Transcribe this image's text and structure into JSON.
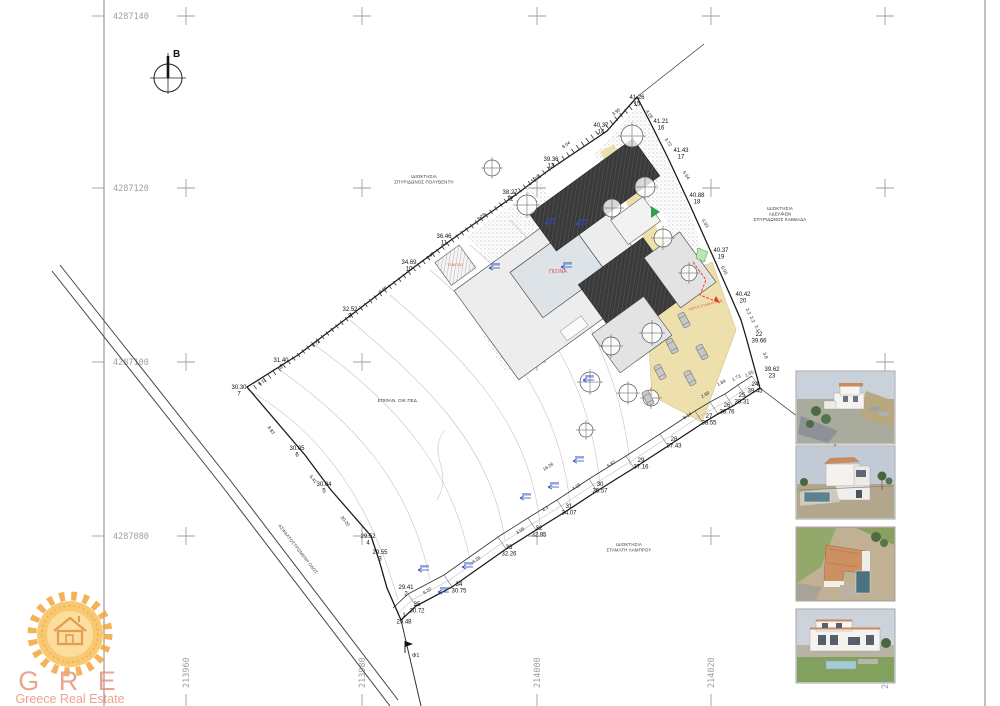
{
  "colors": {
    "road_beige": "#eee0ac",
    "roof_dark": "#3a3a3a",
    "building_gray": "#e3e3e3",
    "pool_label_red": "#e05555",
    "marker_blue": "#2b50c8",
    "green_marker": "#2e9e4f",
    "grid_gray": "#9aa0a6",
    "logo_orange": "#f3a63e",
    "logo_text": "#e8947c"
  },
  "north": {
    "label": "B"
  },
  "grid": {
    "cols": [
      186,
      362,
      537,
      711,
      885
    ],
    "rows": [
      16,
      188,
      362,
      536
    ],
    "row_labels": [
      {
        "text": "4287140",
        "y": 16
      },
      {
        "text": "4287120",
        "y": 188
      },
      {
        "text": "4287100",
        "y": 362
      },
      {
        "text": "4287080",
        "y": 536
      }
    ],
    "col_labels": [
      {
        "text": "213960",
        "x": 186
      },
      {
        "text": "213980",
        "x": 362
      },
      {
        "text": "214000",
        "x": 537
      },
      {
        "text": "214020",
        "x": 711
      }
    ],
    "partial_col_label": {
      "text": "2",
      "x": 885,
      "y": 689
    }
  },
  "plan": {
    "owners": [
      {
        "x": 424,
        "y": 178,
        "lines": [
          "ΙΔΙΟΚΤΗΣΙΑ",
          "ΣΠΥΡΙΔΩΝΟΣ ΠΟΛΥΒΕΝΤΗ"
        ]
      },
      {
        "x": 780,
        "y": 210,
        "lines": [
          "ΙΔΙΟΚΤΗΣΙΑ",
          "ΑΔΕΛΦΩΝ",
          "ΣΠΥΡΙΔΩΝΟΣ ΚΑΒΒΑΔΑ"
        ]
      },
      {
        "x": 629,
        "y": 546,
        "lines": [
          "ΙΔΙΟΚΤΗΣΙΑ",
          "ΣΤΑΜΑΤΗ ΛΑΜΠΡΟΥ"
        ]
      }
    ],
    "road_label": "ΑΣΦΑΛΤΟΣΤΡΩΜΕΝΗ ΟΔΟΣ",
    "area_label": "ΕΠΙΦΑΝ. ΟΙΚ.ΠΕΔ.",
    "pool_label": "ΠΙΣΙΝΑ",
    "jacuzzi_label": "ΤΖΑΚΟΥΖΙ",
    "parking_label": "ΧΩΡΟΣ ΣΤΑΘΜΕΥΣΗΣ",
    "flag_label": "Φ1",
    "points": [
      {
        "l1": "1",
        "l2": "29.48",
        "x": 404,
        "y": 617
      },
      {
        "l1": "29.41",
        "l2": "2",
        "x": 406,
        "y": 589
      },
      {
        "l1": "29.55",
        "l2": "3",
        "x": 380,
        "y": 554
      },
      {
        "l1": "29.52",
        "l2": "4",
        "x": 368,
        "y": 538
      },
      {
        "l1": "30.04",
        "l2": "5",
        "x": 324,
        "y": 486
      },
      {
        "l1": "30.05",
        "l2": "6",
        "x": 297,
        "y": 450
      },
      {
        "l1": "30.30",
        "l2": "7",
        "x": 239,
        "y": 389
      },
      {
        "l1": "31.40",
        "l2": "8",
        "x": 281,
        "y": 362
      },
      {
        "l1": "32.52",
        "l2": "9",
        "x": 350,
        "y": 311
      },
      {
        "l1": "34.69",
        "l2": "10",
        "x": 409,
        "y": 264
      },
      {
        "l1": "36.46",
        "l2": "11",
        "x": 444,
        "y": 238
      },
      {
        "l1": "38.27",
        "l2": "12",
        "x": 510,
        "y": 194
      },
      {
        "l1": "39.36",
        "l2": "13",
        "x": 551,
        "y": 161
      },
      {
        "l1": "40.37",
        "l2": "14",
        "x": 601,
        "y": 127
      },
      {
        "l1": "41.26",
        "l2": "15",
        "x": 637,
        "y": 99
      },
      {
        "l1": "41.21",
        "l2": "16",
        "x": 661,
        "y": 123
      },
      {
        "l1": "41.43",
        "l2": "17",
        "x": 681,
        "y": 152
      },
      {
        "l1": "40.88",
        "l2": "18",
        "x": 697,
        "y": 197
      },
      {
        "l1": "40.37",
        "l2": "19",
        "x": 721,
        "y": 252
      },
      {
        "l1": "40.42",
        "l2": "20",
        "x": 743,
        "y": 296
      },
      {
        "l1": "22",
        "l2": "39.66",
        "x": 759,
        "y": 336
      },
      {
        "l1": "39.62",
        "l2": "23",
        "x": 772,
        "y": 371
      },
      {
        "l1": "24",
        "l2": "39.45",
        "x": 755,
        "y": 386
      },
      {
        "l1": "25",
        "l2": "39.31",
        "x": 742,
        "y": 397
      },
      {
        "l1": "26",
        "l2": "38.76",
        "x": 727,
        "y": 407
      },
      {
        "l1": "27",
        "l2": "38.55",
        "x": 709,
        "y": 418
      },
      {
        "l1": "28",
        "l2": "37.43",
        "x": 674,
        "y": 441
      },
      {
        "l1": "29",
        "l2": "37.16",
        "x": 641,
        "y": 462
      },
      {
        "l1": "30",
        "l2": "35.57",
        "x": 600,
        "y": 486
      },
      {
        "l1": "31",
        "l2": "34.07",
        "x": 569,
        "y": 508
      },
      {
        "l1": "32",
        "l2": "32.95",
        "x": 539,
        "y": 530
      },
      {
        "l1": "33",
        "l2": "32.26",
        "x": 509,
        "y": 549
      },
      {
        "l1": "34",
        "l2": "30.75",
        "x": 459,
        "y": 586
      },
      {
        "l1": "35",
        "l2": "30.72",
        "x": 417,
        "y": 606
      }
    ],
    "edge_labels": [
      {
        "t": "3.95",
        "x": 617,
        "y": 113,
        "r": -36
      },
      {
        "t": "8.04",
        "x": 567,
        "y": 146,
        "r": -36
      },
      {
        "t": "5.19",
        "x": 536,
        "y": 180,
        "r": -36
      },
      {
        "t": "9.29",
        "x": 482,
        "y": 218,
        "r": -36
      },
      {
        "t": "4.47",
        "x": 431,
        "y": 257,
        "r": -36
      },
      {
        "t": "9.55",
        "x": 384,
        "y": 291,
        "r": -36
      },
      {
        "t": "9.74",
        "x": 317,
        "y": 345,
        "r": -36
      },
      {
        "t": "6.11",
        "x": 263,
        "y": 383,
        "r": -36
      },
      {
        "t": "8.83",
        "x": 270,
        "y": 431,
        "r": 52
      },
      {
        "t": "5.41",
        "x": 312,
        "y": 480,
        "r": 52
      },
      {
        "t": "20-20",
        "x": 344,
        "y": 522,
        "r": 52
      },
      {
        "t": "4.28",
        "x": 648,
        "y": 115,
        "r": 56
      },
      {
        "t": "3.72",
        "x": 667,
        "y": 143,
        "r": 56
      },
      {
        "t": "5.64",
        "x": 685,
        "y": 176,
        "r": 56
      },
      {
        "t": "6.03",
        "x": 704,
        "y": 224,
        "r": 60
      },
      {
        "t": "6.05",
        "x": 723,
        "y": 271,
        "r": 62
      },
      {
        "t": "2.2",
        "x": 747,
        "y": 312,
        "r": 65
      },
      {
        "t": "2.2",
        "x": 751,
        "y": 320,
        "r": 65
      },
      {
        "t": "2.1",
        "x": 756,
        "y": 329,
        "r": 65
      },
      {
        "t": "3.8",
        "x": 764,
        "y": 356,
        "r": 70
      },
      {
        "t": "1.84",
        "x": 722,
        "y": 384,
        "r": -28
      },
      {
        "t": "1.73",
        "x": 737,
        "y": 379,
        "r": -28
      },
      {
        "t": "1.65",
        "x": 750,
        "y": 375,
        "r": -28
      },
      {
        "t": "2.58",
        "x": 706,
        "y": 396,
        "r": -32
      },
      {
        "t": "6.14",
        "x": 688,
        "y": 417,
        "r": -32
      },
      {
        "t": "6.82",
        "x": 612,
        "y": 465,
        "r": -33
      },
      {
        "t": "4.18",
        "x": 577,
        "y": 488,
        "r": -33
      },
      {
        "t": "4.3",
        "x": 546,
        "y": 510,
        "r": -33
      },
      {
        "t": "3.08",
        "x": 521,
        "y": 532,
        "r": -33
      },
      {
        "t": "4.28",
        "x": 477,
        "y": 561,
        "r": -33
      },
      {
        "t": "6.20",
        "x": 428,
        "y": 592,
        "r": -33
      },
      {
        "t": "16.26",
        "x": 549,
        "y": 468,
        "r": -33
      }
    ],
    "trees": [
      [
        632,
        136,
        11
      ],
      [
        645,
        187,
        10
      ],
      [
        612,
        208,
        9
      ],
      [
        527,
        205,
        10
      ],
      [
        492,
        168,
        8
      ],
      [
        663,
        238,
        9
      ],
      [
        689,
        273,
        8
      ],
      [
        652,
        333,
        10
      ],
      [
        611,
        346,
        9
      ],
      [
        590,
        382,
        10
      ],
      [
        628,
        393,
        9
      ],
      [
        651,
        398,
        8
      ],
      [
        586,
        430,
        7
      ]
    ],
    "markers": [
      [
        545,
        223
      ],
      [
        576,
        224
      ],
      [
        489,
        268
      ],
      [
        561,
        267
      ],
      [
        583,
        380
      ],
      [
        520,
        498
      ],
      [
        573,
        461
      ],
      [
        548,
        487
      ],
      [
        462,
        567
      ],
      [
        438,
        592
      ],
      [
        418,
        570
      ]
    ],
    "cars": [
      [
        684,
        320
      ],
      [
        672,
        346
      ],
      [
        660,
        372
      ],
      [
        648,
        398
      ],
      [
        702,
        352
      ],
      [
        690,
        378
      ]
    ]
  },
  "photos": [
    {
      "name": "3d-render-aerial"
    },
    {
      "name": "3d-render-garden-pool"
    },
    {
      "name": "3d-render-top-view"
    },
    {
      "name": "3d-render-front-view"
    }
  ],
  "logo": {
    "initials": "G R E",
    "subtitle": "Greece Real Estate"
  }
}
